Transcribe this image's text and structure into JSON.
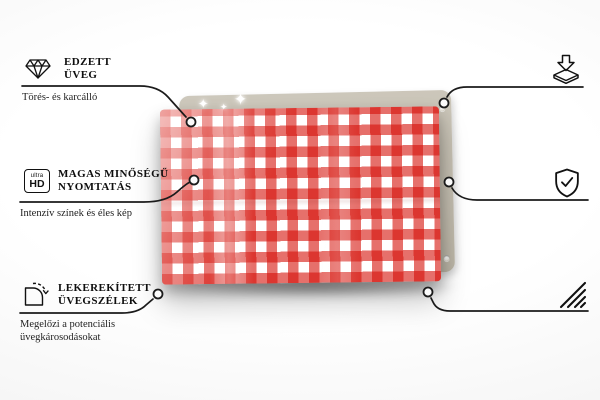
{
  "colors": {
    "gingham_red": "#d61008",
    "back_panel": "#c6c0b2",
    "line_color": "#1b1b1b",
    "background_edge": "#e7e7e7"
  },
  "board": {
    "pattern": "red-white gingham glass board",
    "sparkle_glyph": "✦"
  },
  "features": [
    {
      "id": "tempered-glass",
      "icon": "diamond-icon",
      "title_line1": "EDZETT",
      "title_line2": "ÜVEG",
      "subtitle_line1": "Törés- és karcálló"
    },
    {
      "id": "high-quality-print",
      "icon": "ultra-hd-icon",
      "icon_text_top": "ultra",
      "icon_text_bottom": "HD",
      "title_line1": "MAGAS MINŐSÉGŰ",
      "title_line2": "NYOMTATÁS",
      "subtitle_line1": "Intenzív színek és éles kép"
    },
    {
      "id": "rounded-glass-edges",
      "icon": "rounded-corner-icon",
      "title_line1": "LEKEREKÍTETT",
      "title_line2": "ÜVEGSZÉLEK",
      "subtitle_line1": "Megelőzi a potenciális",
      "subtitle_line2": "üvegkárosodásokat"
    },
    {
      "id": "anti-slip-pads",
      "icon": "pad-arrow-icon",
      "title_line1": "CSÚSZÁSGÁTLÓ",
      "title_line2": "ALÁTÉTEK",
      "subtitle_line1": "Öntapadó gumi",
      "subtitle_line2": "párnák szállítva"
    },
    {
      "id": "protective-film",
      "icon": "shield-check-icon",
      "title_line1": "VÉDŐFÓLIA",
      "subtitle_line1": "Védi a termék hátsó részét"
    },
    {
      "id": "polished-edges",
      "icon": "hatch-icon",
      "title_line1": "CSISZOLT",
      "title_line2": "ÉLEK",
      "subtitle_line1": "Simított és biztonságos",
      "subtitle_line2": "kivitelezés"
    }
  ]
}
